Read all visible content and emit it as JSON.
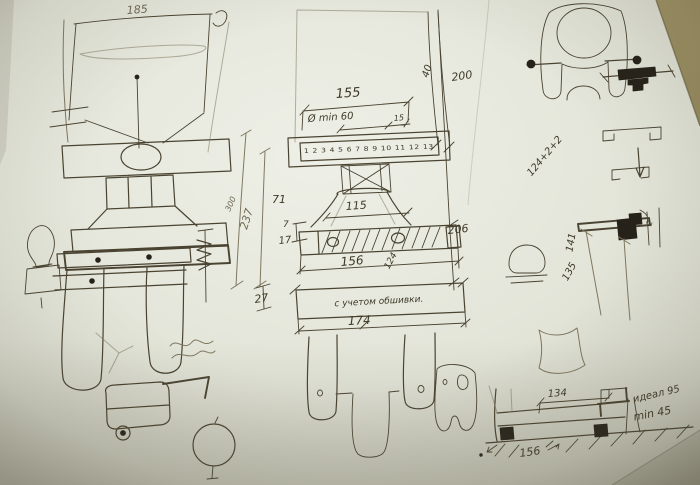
{
  "colors": {
    "table": "#a1925f",
    "paper": "#e9ebe0",
    "ink": "#4a4331",
    "pencil": "#80775f",
    "dark_fill": "#26221a"
  },
  "labels": {
    "left": {
      "height": "185"
    },
    "center": {
      "width_top": "155",
      "diameter_note": "Ø min 60",
      "dim_40": "40",
      "dim_200": "200",
      "dim_15": "15",
      "ruler_numbers": "1 2 3 4 5 6 7 8 9 10 11 12 13",
      "dim_71": "71",
      "dim_7": "7",
      "dim_17": "17",
      "dim_115": "115",
      "dim_156": "156",
      "dim_124": "124",
      "dim_206": "206",
      "dim_237": "237",
      "dim_300": "300",
      "dim_27": "27",
      "cladding_note": "с учетом обшивки.",
      "dim_174": "174"
    },
    "right": {
      "stack_formula": "124+2+2",
      "dim_141": "141",
      "dim_135": "135",
      "dim_2": "2"
    },
    "bottom_right": {
      "dim_134": "134",
      "ideal_note": "идеал 95",
      "min_note": "min 45",
      "dim_156": "156"
    }
  }
}
